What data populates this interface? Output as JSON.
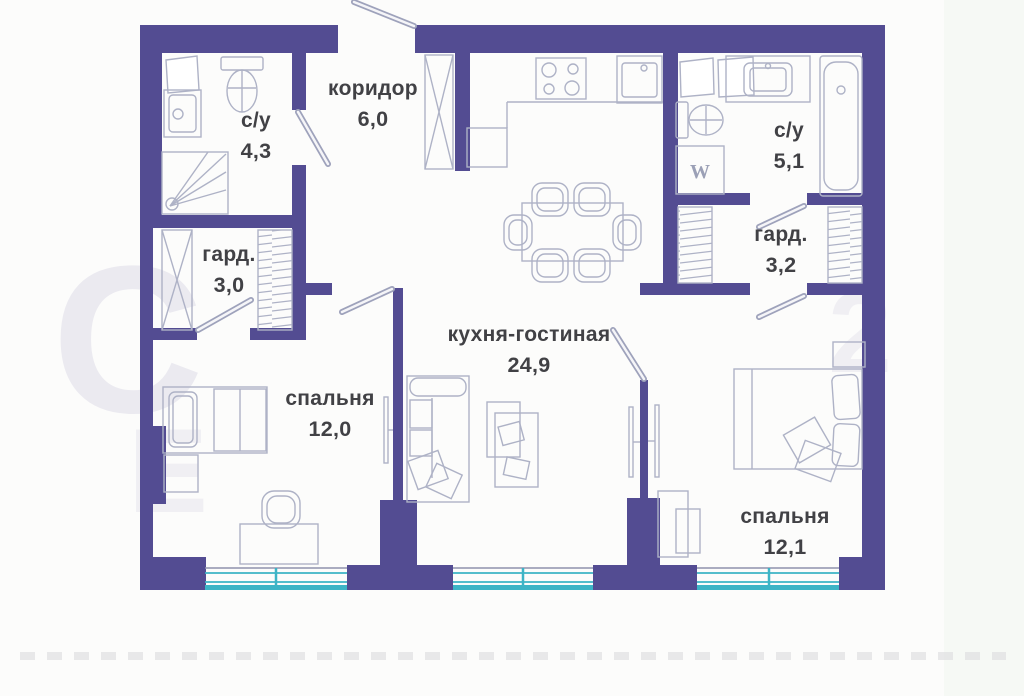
{
  "plan": {
    "rooms": [
      {
        "id": "koridor",
        "name": "коридор",
        "area": "6,0"
      },
      {
        "id": "su1",
        "name": "с/у",
        "area": "4,3"
      },
      {
        "id": "su2",
        "name": "с/у",
        "area": "5,1"
      },
      {
        "id": "gard1",
        "name": "гард.",
        "area": "3,0"
      },
      {
        "id": "gard2",
        "name": "гард.",
        "area": "3,2"
      },
      {
        "id": "bedroom1",
        "name": "спальня",
        "area": "12,0"
      },
      {
        "id": "bedroom2",
        "name": "спальня",
        "area": "12,1"
      },
      {
        "id": "living",
        "name": "кухня-гостиная",
        "area": "24,9"
      }
    ],
    "washer_label": "W",
    "watermark": [
      "С",
      "Е",
      "2"
    ],
    "colors": {
      "wall": "#534C92",
      "line": "#AEB2C6",
      "door": "#9EA2BB",
      "window": "#3DB4C6",
      "text": "#414145",
      "bg": "#FCFCFB",
      "watermark": "#7D76AD"
    }
  }
}
